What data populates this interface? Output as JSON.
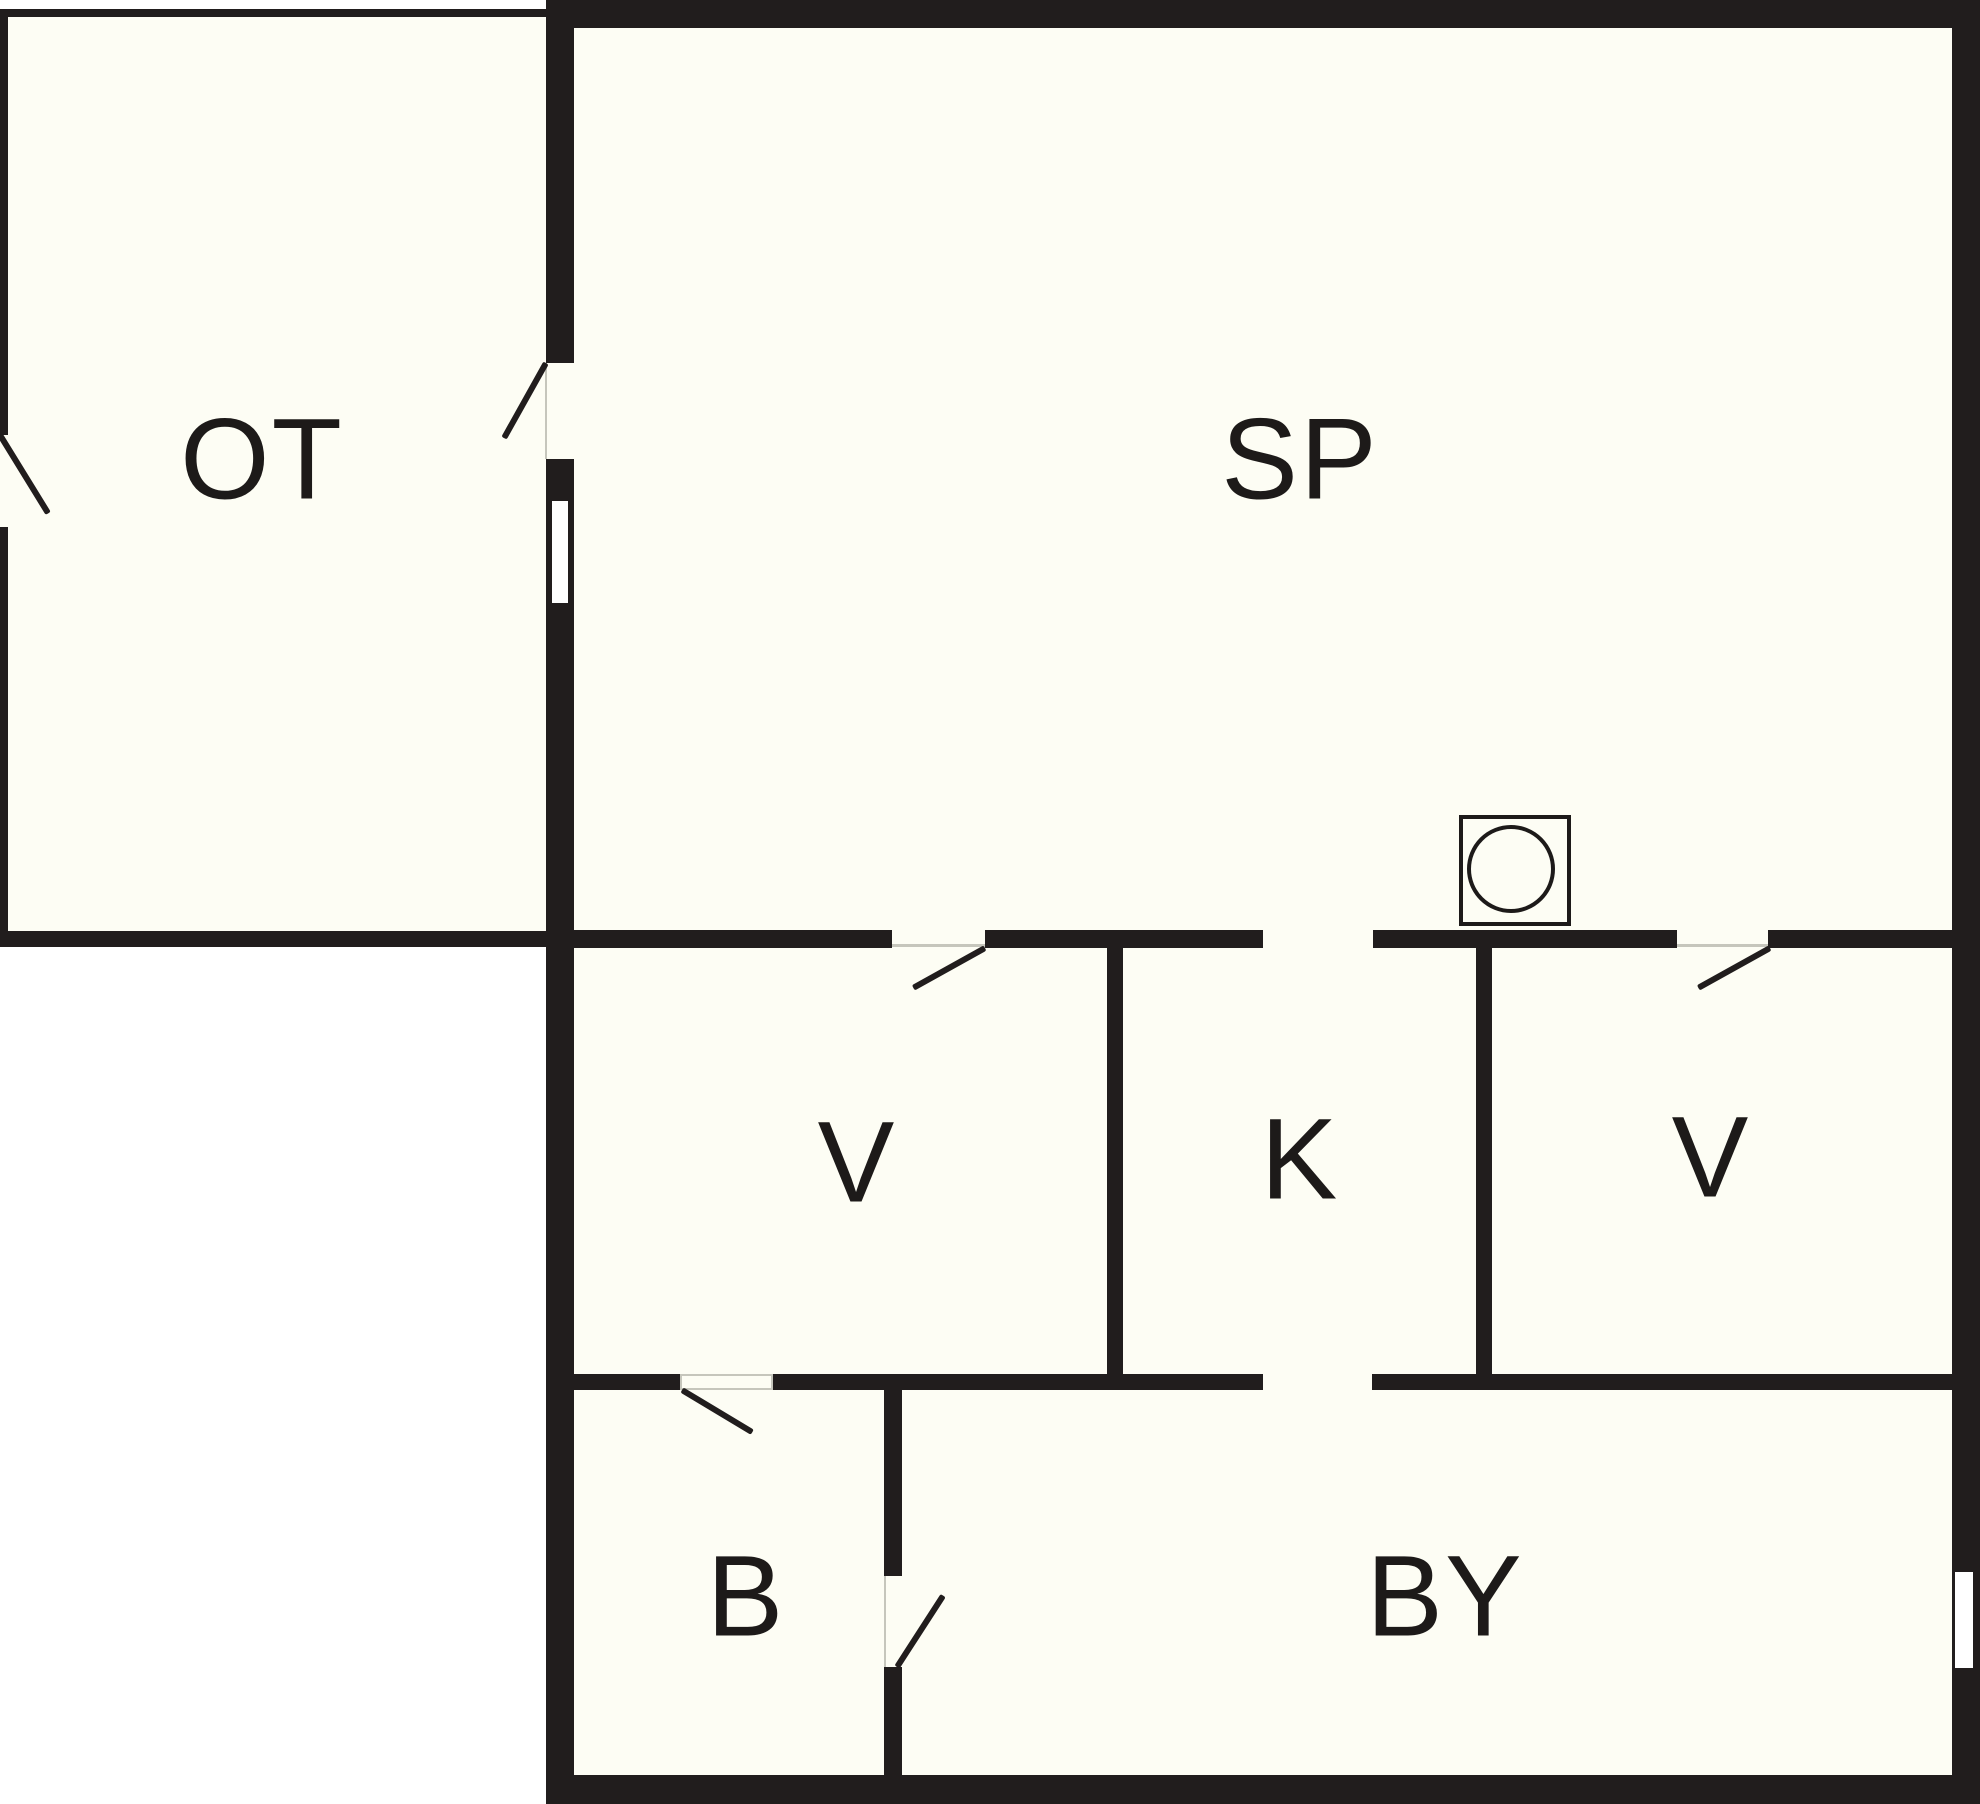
{
  "title": "Floor plan",
  "colors": {
    "wall": "#211d1d",
    "interior": "#fdfdf4",
    "exterior": "#ffffff",
    "label": "#1d1a19",
    "hairline": "#c6c6bc"
  },
  "rooms": {
    "ot": {
      "label": "OT"
    },
    "sp": {
      "label": "SP"
    },
    "v1": {
      "label": "V"
    },
    "k": {
      "label": "K"
    },
    "v2": {
      "label": "V"
    },
    "b": {
      "label": "B"
    },
    "by": {
      "label": "BY"
    }
  },
  "symbols": {
    "stove": "stove-hob-with-burner-circle"
  },
  "features": {
    "doors": [
      "ot-exterior-door",
      "ot-to-sp-door",
      "sp-to-v1-door",
      "sp-to-k-door",
      "sp-to-v2-door",
      "v1-to-b-door",
      "k-to-by-door",
      "b-to-by-door"
    ],
    "windows": [
      "window-in-ot-sp-wall",
      "window-in-by-right-wall"
    ]
  }
}
